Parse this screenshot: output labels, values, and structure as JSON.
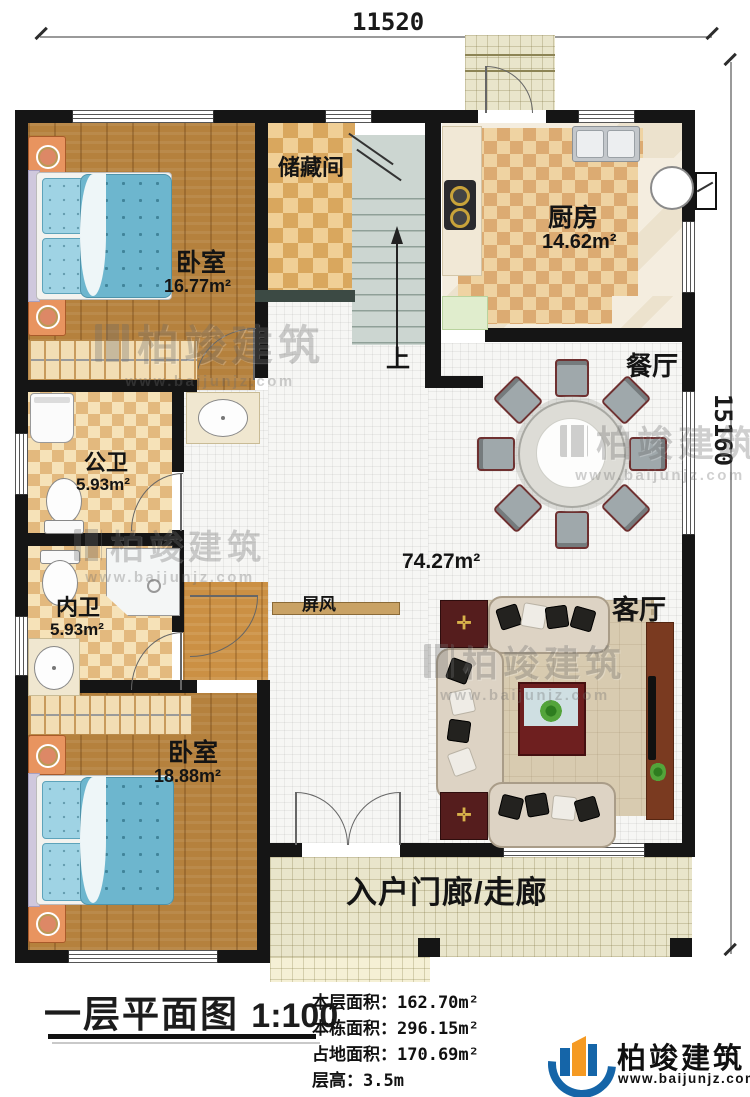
{
  "plan": {
    "dim_top": "11520",
    "dim_right": "15160",
    "rooms": {
      "bedroom1": {
        "name": "卧室",
        "area": "16.77m²"
      },
      "storage": {
        "name": "储藏间"
      },
      "kitchen": {
        "name": "厨房",
        "area": "14.62m²"
      },
      "dining": {
        "name": "餐厅"
      },
      "bath_public": {
        "name": "公卫",
        "area": "5.93m²"
      },
      "bath_inner": {
        "name": "内卫",
        "area": "5.93m²"
      },
      "bedroom2": {
        "name": "卧室",
        "area": "18.88m²"
      },
      "living": {
        "name": "客厅"
      },
      "hall": {
        "area": "74.27m²"
      },
      "screen": {
        "name": "屏风"
      },
      "stairs": {
        "up": "上"
      },
      "porch": {
        "name": "入户门廊/走廊"
      }
    }
  },
  "legend": {
    "title": "一层平面图",
    "scale": "1:100",
    "rows": [
      {
        "label": "本层面积：",
        "value": "162.70m²"
      },
      {
        "label": "本栋面积：",
        "value": "296.15m²"
      },
      {
        "label": "占地面积：",
        "value": "170.69m²"
      },
      {
        "label": "层高：",
        "value": "3.5m"
      }
    ]
  },
  "brand": {
    "name": "柏竣建筑",
    "url": "www.baijunjz.com"
  },
  "watermark": {
    "name": "柏竣建筑",
    "url": "www.baijunjz.com"
  }
}
